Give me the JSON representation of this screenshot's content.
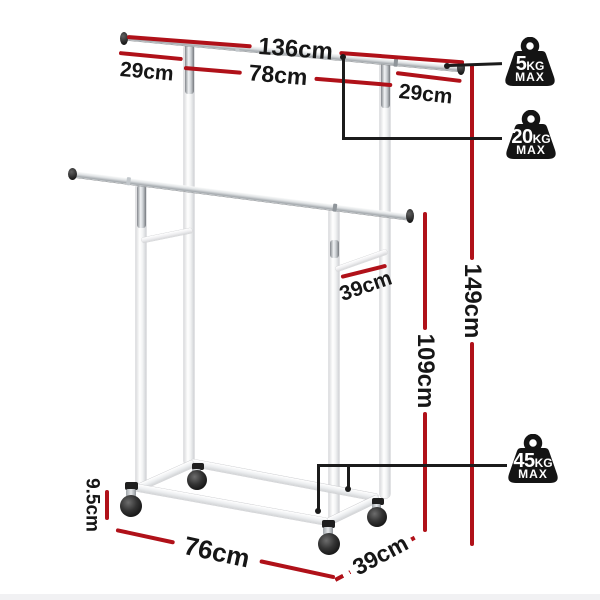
{
  "annotations": {
    "rail_total": "136cm",
    "left_overhang": "29cm",
    "center_span": "78cm",
    "right_overhang": "29cm",
    "side_depth_brace": "39cm",
    "overall_height": "149cm",
    "lower_rail_height": "109cm",
    "caster_height": "9.5cm",
    "base_length": "76cm",
    "base_depth": "39cm"
  },
  "capacity_badges": [
    {
      "value": "5",
      "unit": "KG",
      "qualifier": "MAX"
    },
    {
      "value": "20",
      "unit": "KG",
      "qualifier": "MAX"
    },
    {
      "value": "45",
      "unit": "KG",
      "qualifier": "MAX"
    }
  ],
  "colors": {
    "dimension_line": "#b01119",
    "badge": "#141414",
    "connector": "#1b1b1b"
  }
}
